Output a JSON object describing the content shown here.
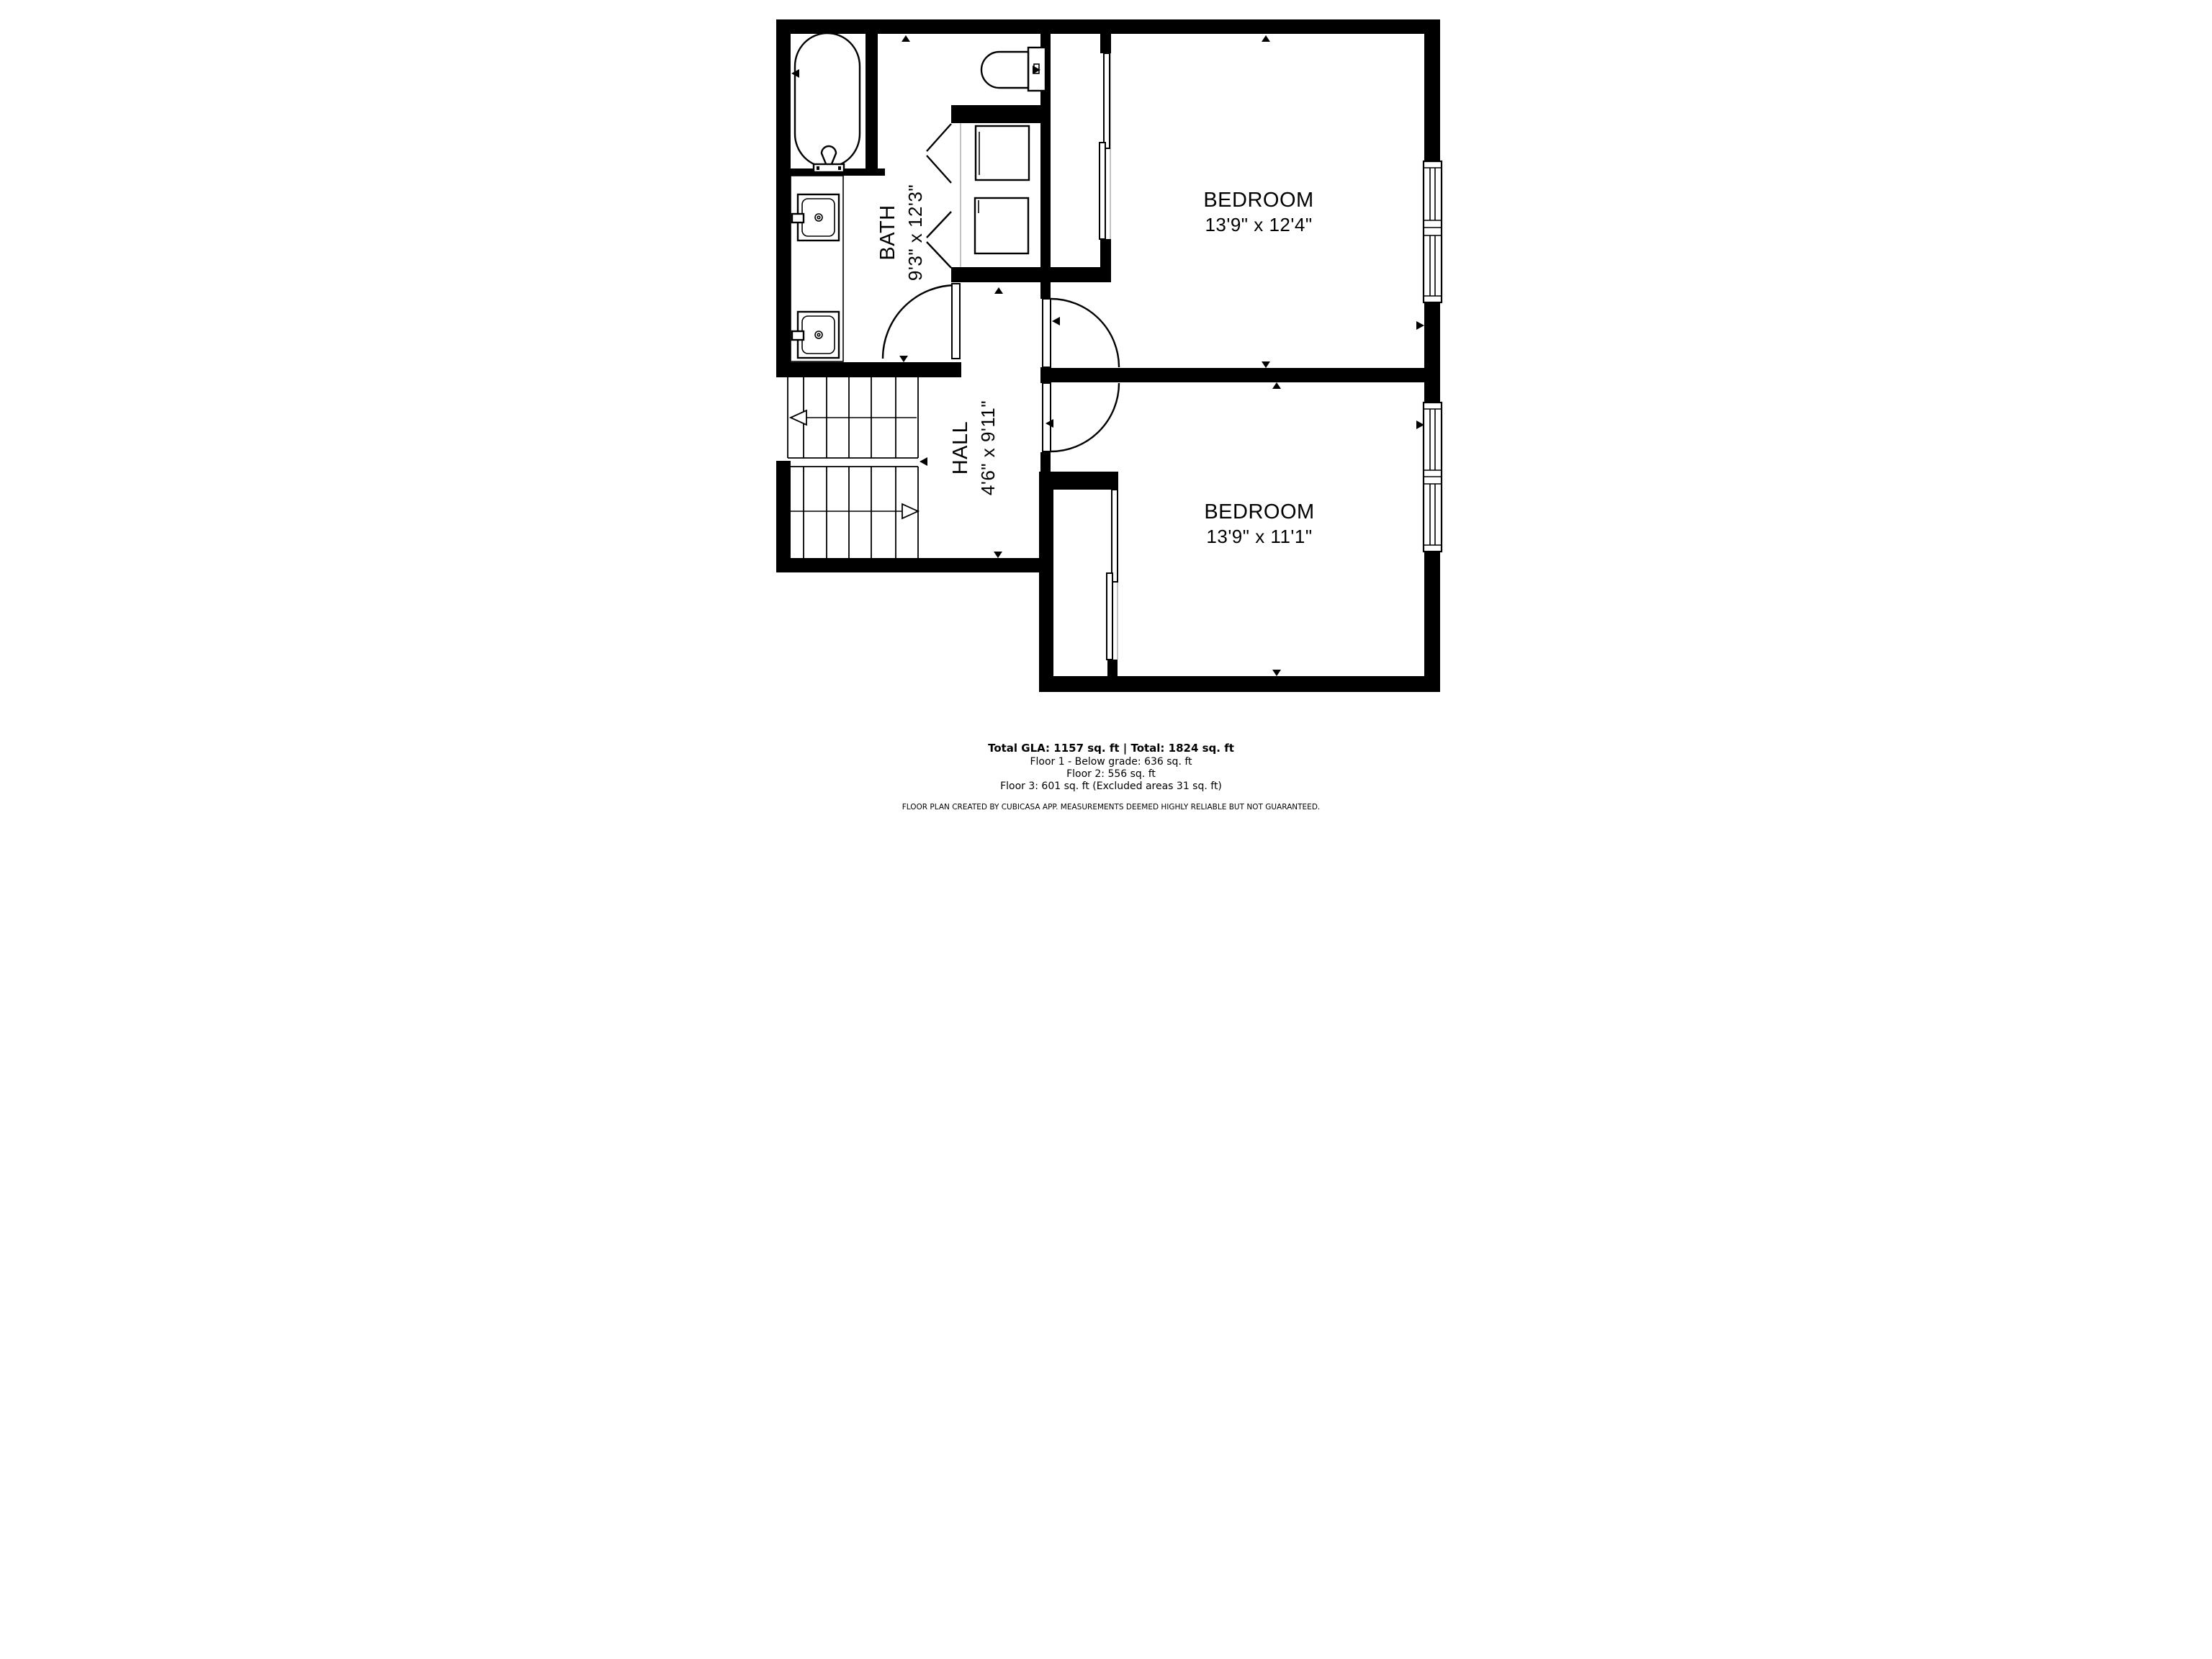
{
  "floor_plan": {
    "app_source": "CubiCasa",
    "rooms": [
      {
        "id": "bath",
        "name": "BATH",
        "dimensions": "9'3\" x 12'3\""
      },
      {
        "id": "hall",
        "name": "HALL",
        "dimensions": "4'6\" x 9'11\""
      },
      {
        "id": "bedroom-top",
        "name": "BEDROOM",
        "dimensions": "13'9\" x 12'4\""
      },
      {
        "id": "bedroom-bottom",
        "name": "BEDROOM",
        "dimensions": "13'9\" x 11'1\""
      }
    ],
    "summary": {
      "total_line": "Total GLA: 1157 sq. ft | Total: 1824 sq. ft",
      "floor1": "Floor 1 - Below grade: 636 sq. ft",
      "floor2": "Floor 2: 556 sq. ft",
      "floor3": "Floor 3: 601 sq. ft (Excluded areas 31 sq. ft)"
    },
    "disclaimer": "FLOOR PLAN CREATED BY CUBICASA APP. MEASUREMENTS DEEMED HIGHLY RELIABLE BUT NOT GUARANTEED.",
    "colors": {
      "line": "#000000",
      "background": "#ffffff",
      "muted_line": "#a9a9a9"
    }
  }
}
